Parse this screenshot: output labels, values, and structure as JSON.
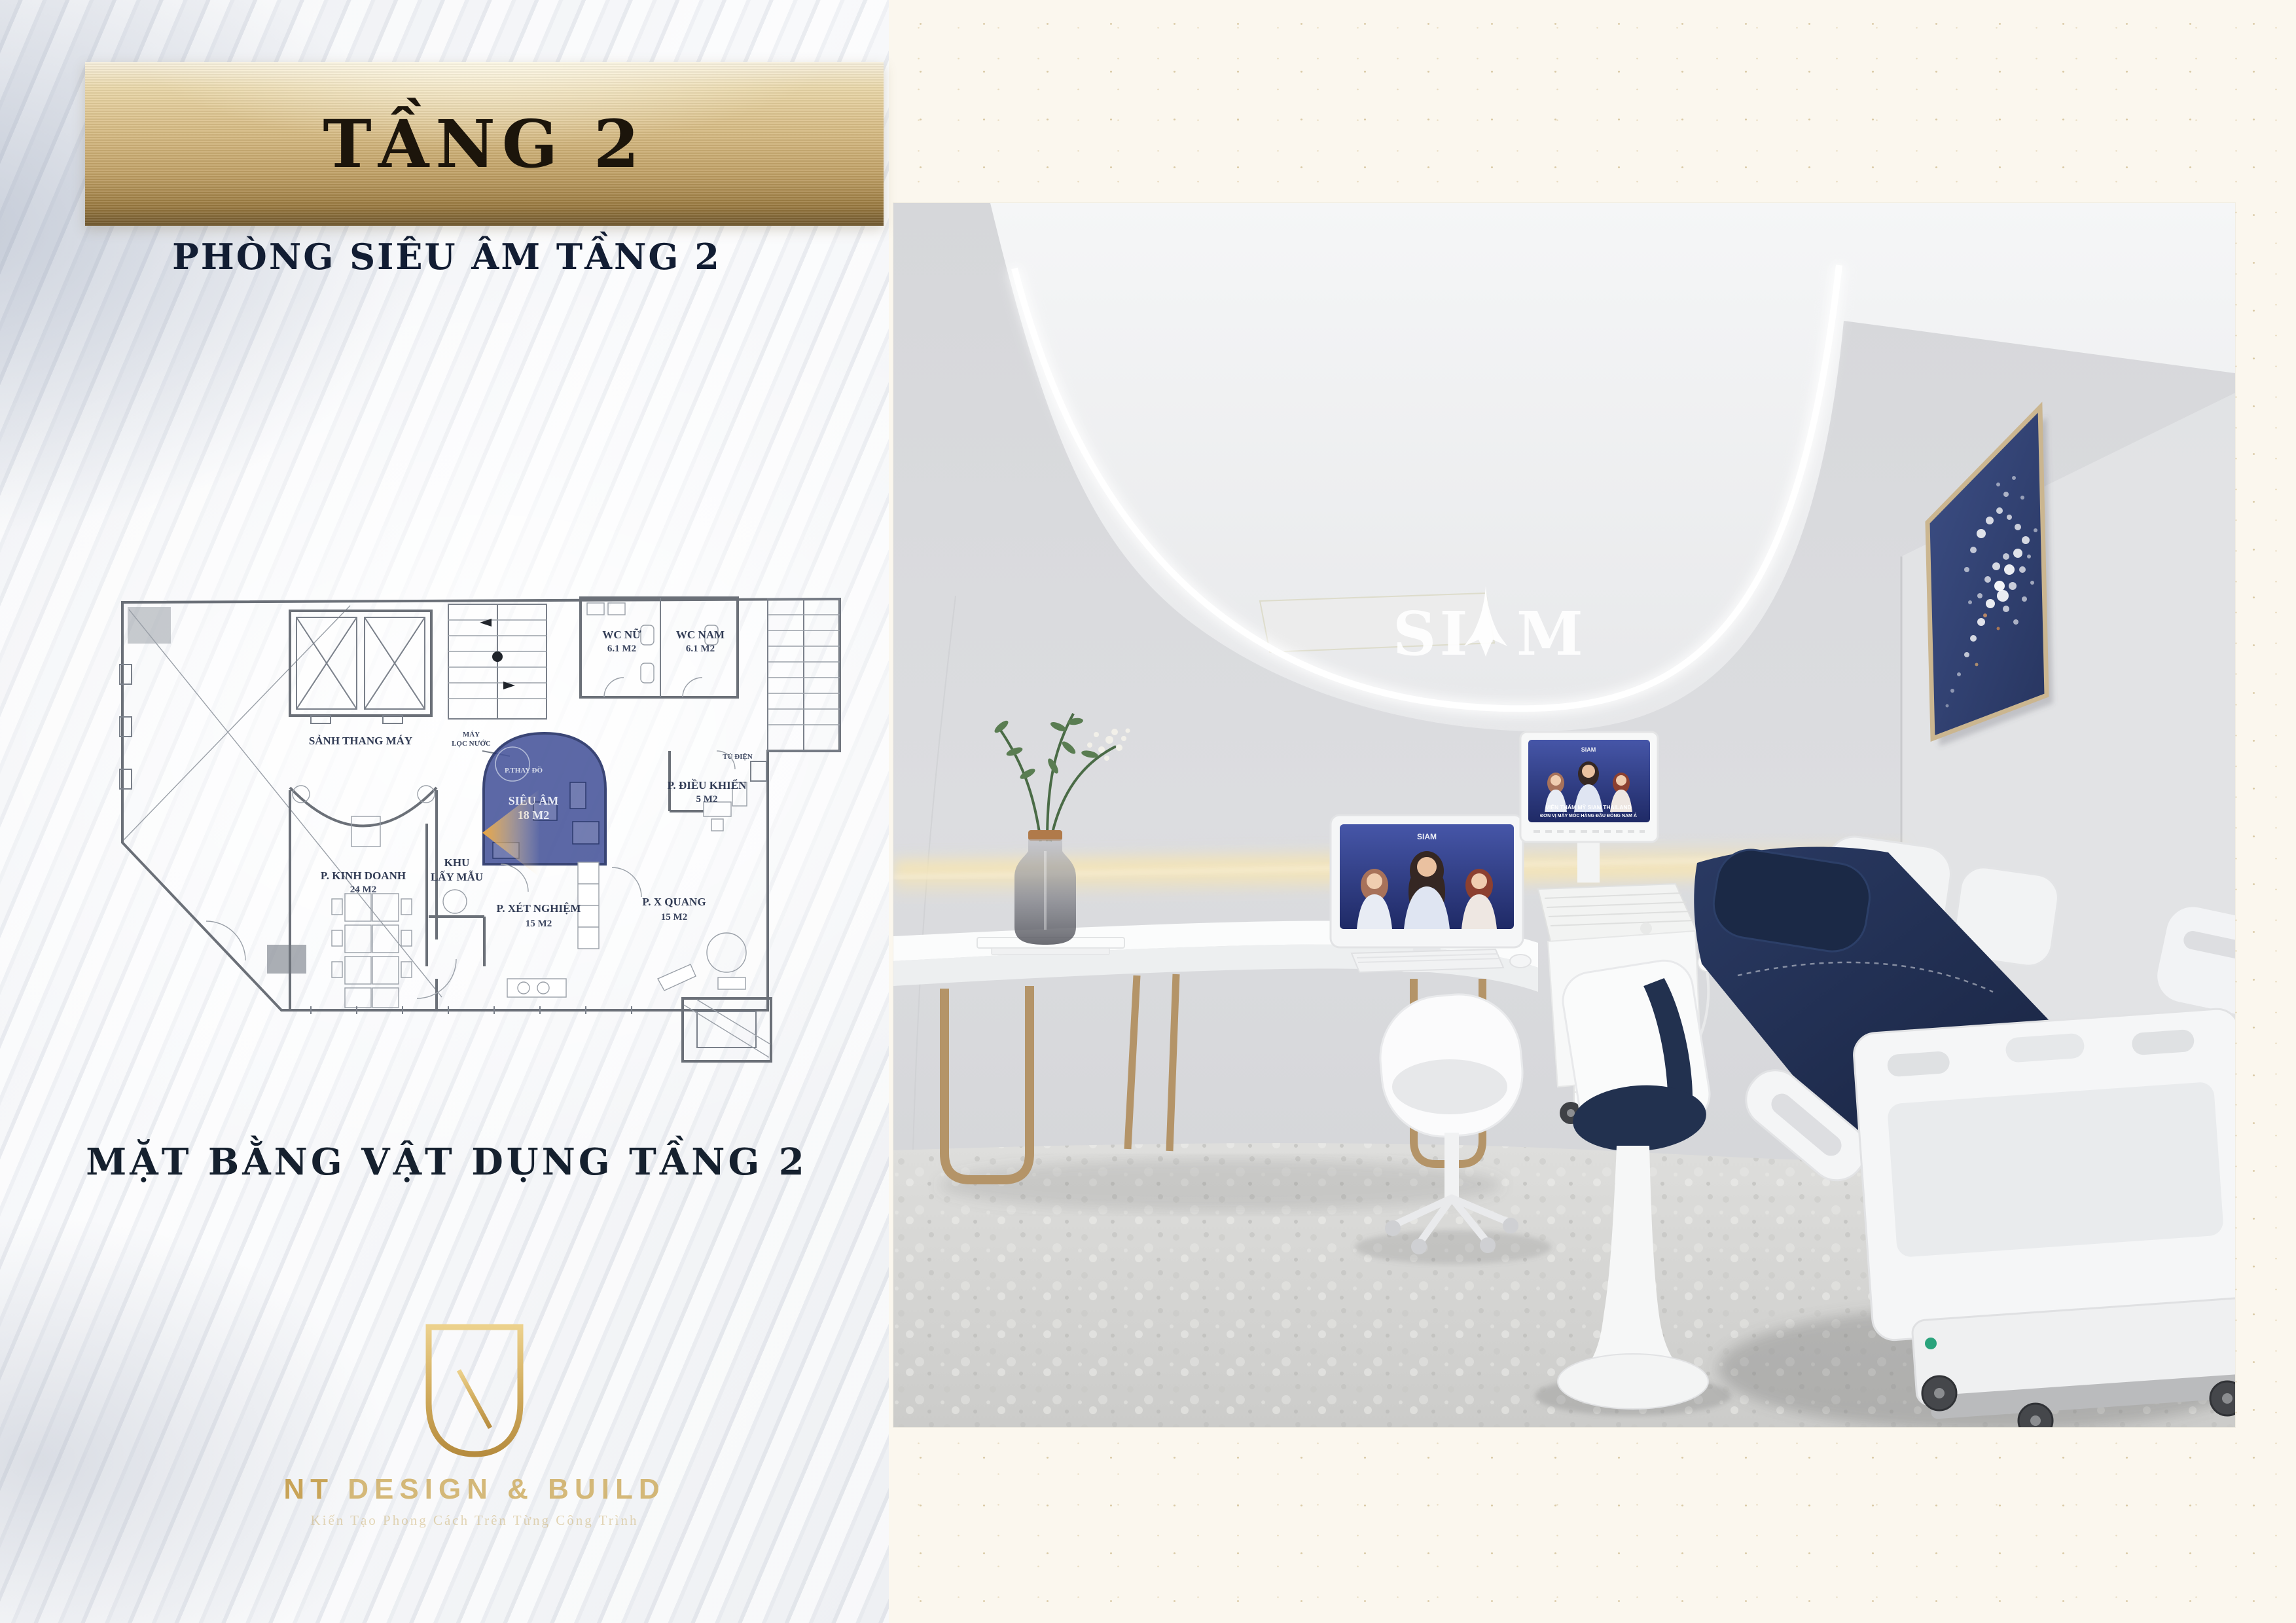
{
  "page": {
    "banner_title": "TẦNG 2",
    "subtitle": "PHÒNG SIÊU ÂM TẦNG 2",
    "plan_caption": "MẶT BẰNG VẬT DỤNG TẦNG 2"
  },
  "floor_plan": {
    "lobby": "SẢNH THANG MÁY",
    "water_filter_1": "MÁY",
    "water_filter_2": "LỌC NƯỚC",
    "wc_nu": "WC NỮ",
    "wc_nu_area": "6.1 M2",
    "wc_nam": "WC NAM",
    "wc_nam_area": "6.1 M2",
    "tu_dien": "TỦ ĐIỆN",
    "dieu_khien": "P. ĐIỀU KHIỂN",
    "dieu_khien_area": "5 M2",
    "kinh_doanh": "P. KINH DOANH",
    "kinh_doanh_area": "24 M2",
    "khu": "KHU",
    "lay_mau": "LẤY MẪU",
    "sieu_am": "SIÊU ÂM",
    "sieu_am_area": "18 M2",
    "thay_do": "P.THAY ĐỒ",
    "xet_nghiem": "P. XÉT NGHIỆM",
    "xet_nghiem_area": "15 M2",
    "x_quang": "P. X QUANG",
    "x_quang_area": "15 M2"
  },
  "logo": {
    "brand_bold": "NT",
    "brand_rest": "DESIGN & BUILD",
    "tagline": "Kiến Tạo Phong Cách Trên Từng Công Trình"
  },
  "render": {
    "wall_logo_left": "SI",
    "wall_logo_right": "M",
    "imac_brand": "SIAM",
    "us_brand": "SIAM",
    "us_caption_1": "VIỆN THẨM MỸ SIAM THAILAND",
    "us_caption_2": "ĐƠN VỊ MÁY MÓC HÀNG ĐẦU ĐÔNG NAM Á"
  },
  "colors": {
    "gold": "#c9a85c",
    "banner_text": "#1c150b",
    "highlight_room": "#46549a",
    "view_cone": "#f2a93b",
    "bed_navy": "#22314f",
    "brass": "#b59a6e",
    "page_cream": "#fbf7ee"
  }
}
